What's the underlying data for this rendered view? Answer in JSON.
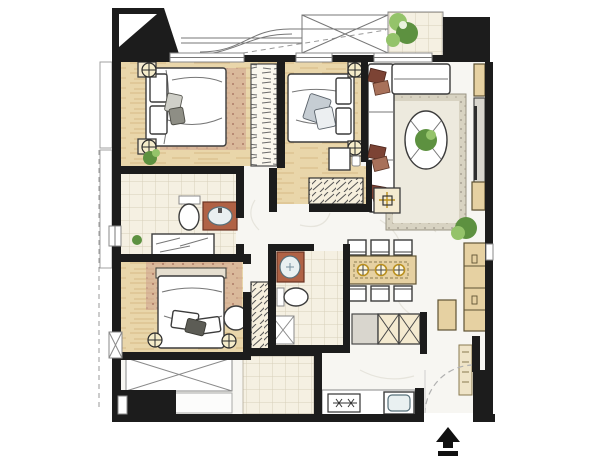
{
  "canvas": {
    "width": 600,
    "height": 476,
    "background": "#ffffff"
  },
  "palette": {
    "wall": "#1c1c1c",
    "marble": "#f7f6f2",
    "marble_vein": "#e6e4dc",
    "wood_floor": "#e9d6aa",
    "wood_streak": "#c9a36a",
    "wood_cabinet": "#e6d1a2",
    "tile_floor": "#f5f0e2",
    "tile_line": "#d8cfba",
    "rug_living_border": "#d8d3c2",
    "rug_living_inner": "#edeade",
    "rug_bedroom": "#c8988a",
    "terracotta": "#b06245",
    "pillow_dark": "#7c4334",
    "pillow_light": "#a8715a",
    "plant_green": "#5d9140",
    "plant_green_light": "#94c36a",
    "gold": "#b98f1e"
  },
  "floor_plan": {
    "type": "apartment-floor-plan",
    "style": "hand-rendered-watercolor",
    "entrance_marker": "black-arrow-up-with-bar",
    "rooms": [
      {
        "id": "living-room",
        "furniture": [
          "l-shaped-sofa",
          "accent-pillows",
          "oval-coffee-table",
          "coffee-table-plant",
          "area-rug",
          "tv-console",
          "side-table"
        ]
      },
      {
        "id": "dining-area",
        "furniture": [
          "dining-table",
          "six-dining-chairs",
          "three-pendant-lamps",
          "tall-cabinet",
          "potted-plant"
        ]
      },
      {
        "id": "kitchen",
        "furniture": [
          "x-front-base-cabinets",
          "counter-appliance",
          "cooktop-two-burners",
          "kitchen-sink"
        ]
      },
      {
        "id": "master-bedroom",
        "furniture": [
          "double-bed",
          "pillows",
          "nightstand-lamps",
          "desk",
          "hatched-dresser"
        ]
      },
      {
        "id": "bedroom-2",
        "furniture": [
          "double-bed",
          "pillows",
          "nightstand-lamps",
          "wardrobe",
          "area-rug",
          "potted-plant"
        ]
      },
      {
        "id": "bedroom-3",
        "furniture": [
          "double-bed",
          "pillows",
          "round-pouf",
          "hall-wardrobe",
          "area-rug",
          "nightstand-lamps"
        ]
      },
      {
        "id": "bathroom-1",
        "furniture": [
          "toilet",
          "terracotta-vanity-basin",
          "bathtub"
        ]
      },
      {
        "id": "bathroom-2",
        "furniture": [
          "terracotta-vanity-basin",
          "toilet",
          "x-service-shaft"
        ]
      },
      {
        "id": "balcony-top",
        "furniture": [
          "tile-floor",
          "potted-plants"
        ]
      },
      {
        "id": "balcony-bottom",
        "furniture": [
          "x-equipment-platform",
          "tile-floor"
        ]
      },
      {
        "id": "entry",
        "furniture": [
          "entry-door-swing",
          "entry-wall-block"
        ]
      }
    ]
  }
}
